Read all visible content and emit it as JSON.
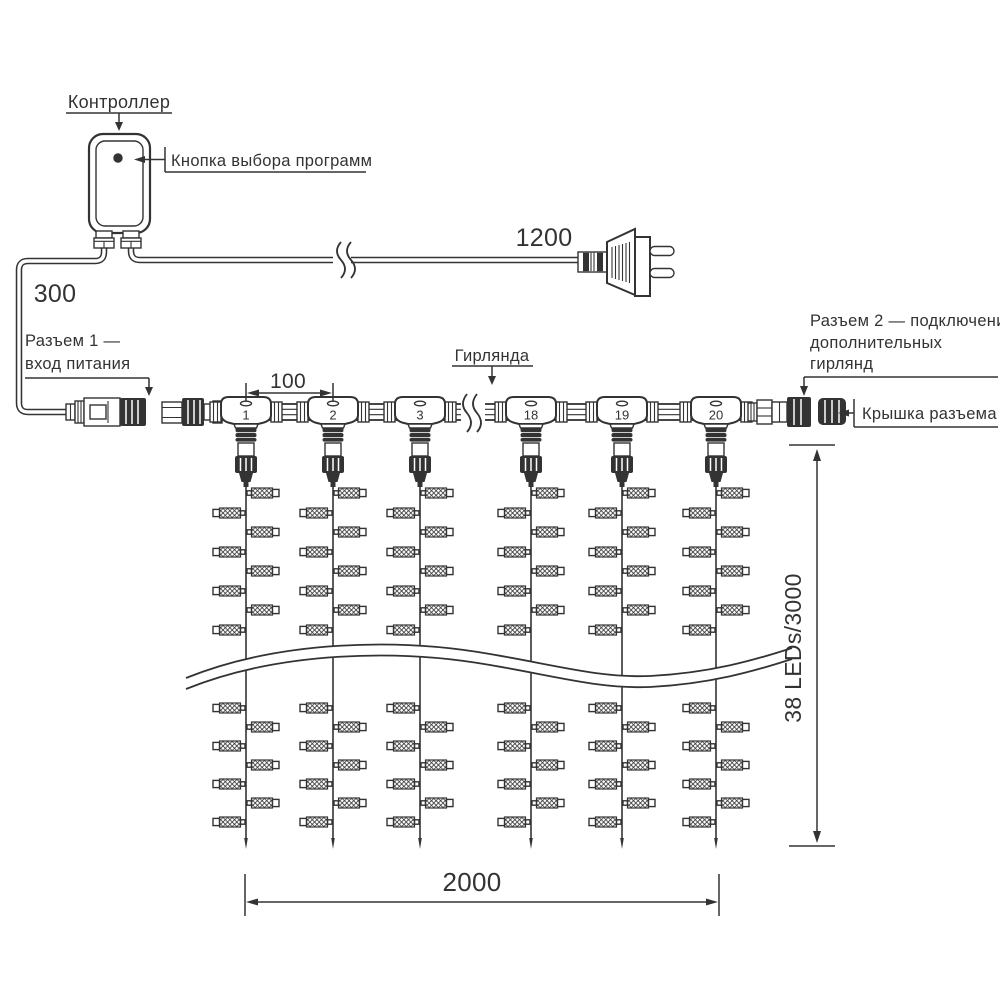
{
  "colors": {
    "line": "#333333",
    "background": "#ffffff"
  },
  "controller": {
    "label": "Контроллер",
    "button_label": "Кнопка выбора программ"
  },
  "connector1": {
    "label_line1": "Разъем 1 —",
    "label_line2": "вход питания"
  },
  "connector2": {
    "label_line1": "Разъем 2 — подключение",
    "label_line2": "дополнительных",
    "label_line3": "гирлянд",
    "cap_label": "Крышка разъема"
  },
  "garland": {
    "label": "Гирлянда",
    "connector_numbers": [
      "1",
      "2",
      "3",
      "18",
      "19",
      "20"
    ]
  },
  "dimensions": {
    "controller_cable_mm": "300",
    "power_cord_mm": "1200",
    "connector_spacing_mm": "100",
    "curtain_width_mm": "2000",
    "strand_spec": "38 LEDs/3000"
  }
}
